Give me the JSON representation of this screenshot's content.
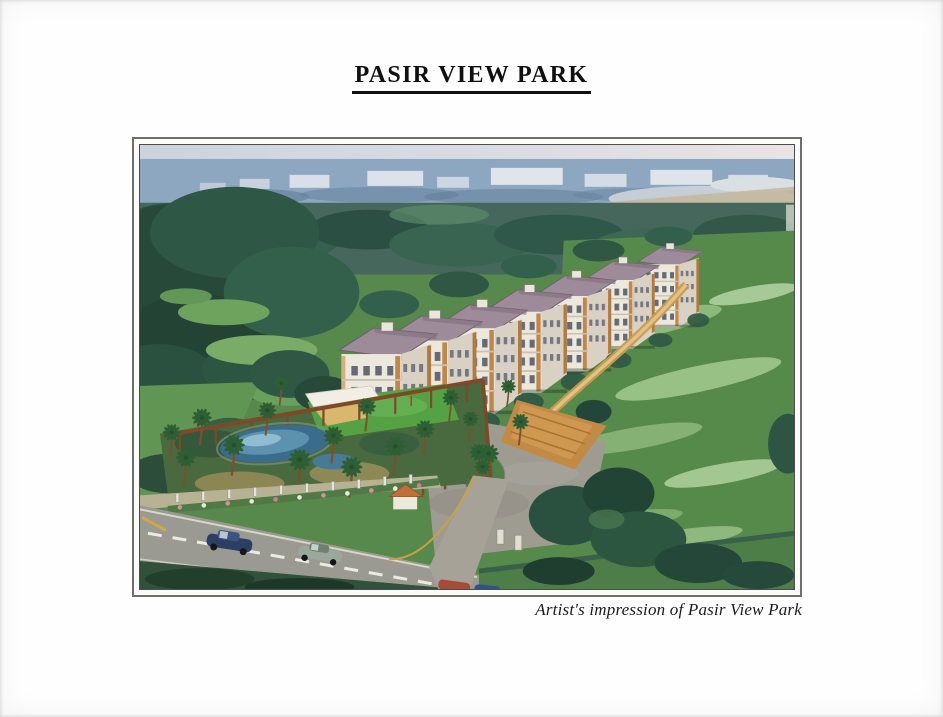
{
  "header": {
    "title": "PASIR VIEW PARK"
  },
  "figure": {
    "caption": "Artist's impression of Pasir View Park",
    "illustration_alt": "Aerial watercolour artist's impression of Pasir View Park: a diagonal row of white low-rise apartment blocks with mauve hipped roofs set in lush greenery, a landscaped podium with swimming pool, putting green and palm trees in the left foreground, an entrance court and driveway meeting a road with passing cars along the bottom, open green fields to the right and a hazy blue city skyline with water on the horizon.",
    "palette": {
      "sky_haze": "#d9dce3",
      "city_blue": "#8ea7c1",
      "forest_dark": "#27493a",
      "field_green": "#568a4b",
      "field_light": "#98c186",
      "building_white": "#ece8dc",
      "roof_mauve": "#9d8b99",
      "accent_orange": "#c08748",
      "pool_blue": "#5c92ae",
      "road_grey": "#9b9a92",
      "path_tan": "#c69c55"
    }
  }
}
